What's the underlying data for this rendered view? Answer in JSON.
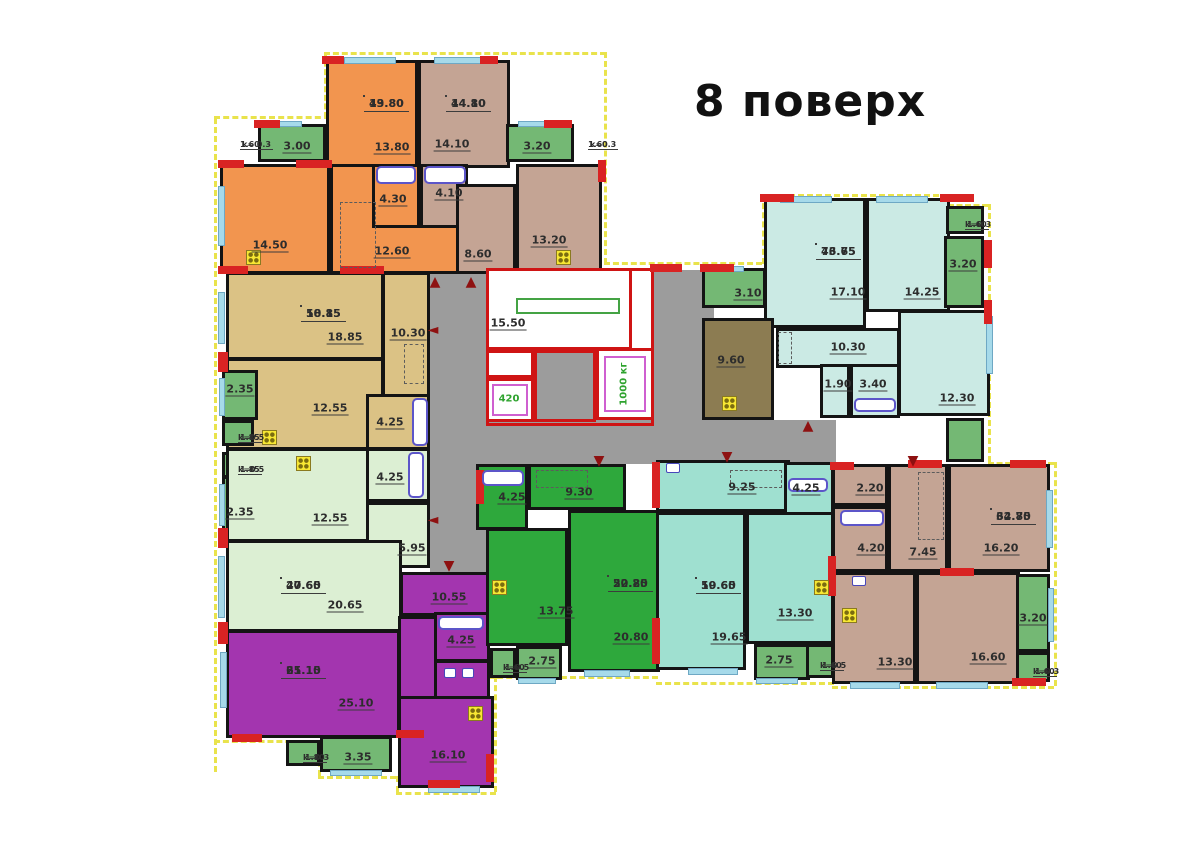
{
  "title": "8 поверх",
  "palette": {
    "orange": "#f2954f",
    "tan": "#c4a494",
    "khaki": "#dbc285",
    "lightgreen": "#dcefd3",
    "balc": "#74b874",
    "darkgreen": "#2ea83c",
    "teal": "#9fe0d0",
    "lightteal": "#cbeae4",
    "purple": "#a335af",
    "olive": "#8c7c52",
    "grey": "#9c9c9c",
    "white": "#ffffff",
    "red_wall": "#cf1414",
    "window": "#a6daea",
    "outline_yellow": "#e9e34c"
  },
  "corridors": [
    [
      "corridor-left",
      "grey",
      430,
      270,
      58,
      304
    ],
    [
      "corridor-bottom",
      "grey",
      430,
      420,
      406,
      44
    ],
    [
      "corridor-right",
      "grey",
      654,
      270,
      60,
      154
    ]
  ],
  "rooms": [
    [
      "room-13-80",
      "orange",
      326,
      60,
      92,
      108,
      ""
    ],
    [
      "room-14-50",
      "orange",
      220,
      164,
      110,
      110,
      ""
    ],
    [
      "room-12-60",
      "orange",
      330,
      164,
      130,
      110,
      ""
    ],
    [
      "bath-4-30",
      "orange",
      372,
      164,
      48,
      64,
      ""
    ],
    [
      "room-14-10",
      "tan",
      418,
      60,
      92,
      108,
      ""
    ],
    [
      "bath-4-10",
      "tan",
      420,
      164,
      48,
      64,
      ""
    ],
    [
      "hall-8-60",
      "tan",
      456,
      184,
      60,
      90,
      ""
    ],
    [
      "kitchen-13-20",
      "tan",
      516,
      164,
      86,
      110,
      ""
    ],
    [
      "balcony-3-00",
      "balc",
      258,
      124,
      68,
      38,
      ""
    ],
    [
      "balcony-3-20-top",
      "balc",
      506,
      124,
      68,
      38,
      ""
    ],
    [
      "room-18-85",
      "khaki",
      226,
      272,
      158,
      88,
      ""
    ],
    [
      "hall-10-30-left",
      "khaki",
      382,
      272,
      48,
      130,
      ""
    ],
    [
      "room-12-55-khaki",
      "khaki",
      226,
      358,
      158,
      92,
      ""
    ],
    [
      "bath-4-25-khaki",
      "khaki",
      366,
      394,
      64,
      56,
      ""
    ],
    [
      "balcony-2-35-a",
      "balc",
      222,
      370,
      36,
      50,
      ""
    ],
    [
      "coefbox-1-85-a",
      "balc",
      222,
      420,
      32,
      26,
      ""
    ],
    [
      "coefbox-1-85-b",
      "balc",
      222,
      452,
      32,
      26,
      ""
    ],
    [
      "balcony-2-35-b",
      "balc",
      222,
      476,
      36,
      56,
      ""
    ],
    [
      "room-12-55-green",
      "lightgreen",
      226,
      448,
      158,
      94,
      ""
    ],
    [
      "bath-4-25-green",
      "lightgreen",
      366,
      448,
      64,
      54,
      ""
    ],
    [
      "hall-5-95",
      "lightgreen",
      366,
      502,
      64,
      66,
      ""
    ],
    [
      "room-20-65",
      "lightgreen",
      226,
      540,
      176,
      92,
      ""
    ],
    [
      "hall-10-55",
      "purple",
      400,
      572,
      90,
      44,
      ""
    ],
    [
      "hall-purple",
      "purple",
      398,
      616,
      42,
      118,
      ""
    ],
    [
      "bath-4-25-purple",
      "purple",
      434,
      612,
      56,
      50,
      ""
    ],
    [
      "wc-purple",
      "purple",
      434,
      660,
      56,
      40,
      ""
    ],
    [
      "room-25-10",
      "purple",
      226,
      630,
      174,
      108,
      ""
    ],
    [
      "room-16-10",
      "purple",
      398,
      696,
      96,
      92,
      ""
    ],
    [
      "balcony-3-35",
      "balc",
      320,
      736,
      72,
      36,
      ""
    ],
    [
      "coefbox-1-80",
      "balc",
      286,
      740,
      34,
      26,
      ""
    ],
    [
      "coefbox-1-60-mid",
      "balc",
      490,
      648,
      26,
      30,
      ""
    ],
    [
      "bath-4-25-dgreen",
      "darkgreen",
      476,
      464,
      52,
      66,
      ""
    ],
    [
      "hall-9-30",
      "darkgreen",
      528,
      464,
      98,
      46,
      ""
    ],
    [
      "kitchen-13-75",
      "darkgreen",
      486,
      528,
      82,
      118,
      ""
    ],
    [
      "room-20-80",
      "darkgreen",
      568,
      510,
      92,
      162,
      ""
    ],
    [
      "balcony-2-75-a",
      "balc",
      516,
      646,
      46,
      34,
      ""
    ],
    [
      "hall-9-25",
      "teal",
      656,
      460,
      134,
      52,
      ""
    ],
    [
      "bath-4-25-teal",
      "teal",
      784,
      462,
      50,
      64,
      ""
    ],
    [
      "room-19-65",
      "teal",
      656,
      512,
      90,
      158,
      ""
    ],
    [
      "kitchen-13-30-teal",
      "teal",
      746,
      512,
      88,
      132,
      ""
    ],
    [
      "balcony-2-75-b",
      "balc",
      754,
      644,
      56,
      36,
      ""
    ],
    [
      "coefbox-1-60-teal",
      "balc",
      806,
      644,
      28,
      34,
      ""
    ],
    [
      "wc-2-20",
      "tan",
      832,
      464,
      56,
      42,
      ""
    ],
    [
      "bath-4-20",
      "tan",
      832,
      506,
      56,
      66,
      ""
    ],
    [
      "hall-7-45",
      "tan",
      888,
      464,
      60,
      108,
      ""
    ],
    [
      "room-16-20",
      "tan",
      948,
      464,
      102,
      108,
      ""
    ],
    [
      "kitchen-13-30-tan",
      "tan",
      832,
      572,
      84,
      112,
      ""
    ],
    [
      "room-16-60",
      "tan",
      916,
      572,
      104,
      112,
      ""
    ],
    [
      "balcony-3-20-right",
      "balc",
      1016,
      574,
      34,
      78,
      "hatch"
    ],
    [
      "coefbox-1-60-br",
      "balc",
      1016,
      652,
      34,
      30,
      ""
    ],
    [
      "room-17-10",
      "lightteal",
      764,
      198,
      102,
      130,
      ""
    ],
    [
      "room-14-25",
      "lightteal",
      866,
      198,
      84,
      114,
      ""
    ],
    [
      "hall-10-30-right",
      "lightteal",
      776,
      328,
      124,
      40,
      ""
    ],
    [
      "wc-1-90",
      "lightteal",
      820,
      364,
      30,
      54,
      ""
    ],
    [
      "bath-3-40",
      "lightteal",
      850,
      364,
      50,
      54,
      ""
    ],
    [
      "room-12-30",
      "lightteal",
      898,
      310,
      92,
      106,
      ""
    ],
    [
      "kitchen-9-60",
      "olive",
      702,
      318,
      72,
      102,
      ""
    ],
    [
      "balcony-3-10",
      "balc",
      702,
      268,
      64,
      40,
      ""
    ],
    [
      "balcony-3-20-topright",
      "balc",
      944,
      236,
      40,
      72,
      "hatch"
    ],
    [
      "coefbox-1-60-tr",
      "balc",
      946,
      206,
      38,
      28,
      ""
    ],
    [
      "balcony-small-right",
      "balc",
      946,
      418,
      38,
      44,
      ""
    ]
  ],
  "core": {
    "frame": [
      486,
      268,
      168,
      158
    ],
    "stair_room": [
      486,
      268,
      146,
      82
    ],
    "stair_label": {
      "t": "15.50",
      "x": 508,
      "y": 324
    },
    "rail": [
      516,
      298,
      104,
      16
    ],
    "cells": [
      [
        "core-cell",
        "white",
        486,
        350,
        48,
        28
      ],
      [
        "lift-420-shaft",
        "white",
        486,
        378,
        48,
        44
      ],
      [
        "lift-1000-shaft",
        "white",
        596,
        348,
        58,
        72
      ],
      [
        "core-vestibule",
        "grey",
        534,
        350,
        62,
        72
      ]
    ],
    "lift_boxes": [
      [
        492,
        384,
        36,
        32
      ],
      [
        604,
        356,
        42,
        56
      ]
    ],
    "lift_labels": [
      {
        "t": "420",
        "x": 509,
        "y": 399,
        "rot": false
      },
      {
        "t": "1000 кг",
        "x": 624,
        "y": 384,
        "rot": true
      }
    ]
  },
  "labels": [
    {
      "t": "3.00",
      "x": 297,
      "y": 147
    },
    {
      "t": "13.80",
      "x": 392,
      "y": 148
    },
    {
      "t": "14.10",
      "x": 452,
      "y": 145
    },
    {
      "t": "3.20",
      "x": 537,
      "y": 147
    },
    {
      "t": "14.50",
      "x": 270,
      "y": 246
    },
    {
      "t": "4.30",
      "x": 393,
      "y": 200
    },
    {
      "t": "4.10",
      "x": 449,
      "y": 194
    },
    {
      "t": "12.60",
      "x": 392,
      "y": 252
    },
    {
      "t": "8.60",
      "x": 478,
      "y": 255
    },
    {
      "t": "13.20",
      "x": 549,
      "y": 241
    },
    {
      "t": "18.85",
      "x": 345,
      "y": 338
    },
    {
      "t": "10.30",
      "x": 408,
      "y": 334
    },
    {
      "t": "12.55",
      "x": 330,
      "y": 409
    },
    {
      "t": "4.25",
      "x": 390,
      "y": 423
    },
    {
      "t": "2.35",
      "x": 240,
      "y": 390
    },
    {
      "t": "2.35",
      "x": 240,
      "y": 513
    },
    {
      "t": "12.55",
      "x": 330,
      "y": 519
    },
    {
      "t": "4.25",
      "x": 390,
      "y": 478
    },
    {
      "t": "5.95",
      "x": 412,
      "y": 549
    },
    {
      "t": "20.65",
      "x": 345,
      "y": 606
    },
    {
      "t": "10.55",
      "x": 449,
      "y": 598
    },
    {
      "t": "25.10",
      "x": 356,
      "y": 704
    },
    {
      "t": "4.25",
      "x": 461,
      "y": 641
    },
    {
      "t": "16.10",
      "x": 448,
      "y": 756
    },
    {
      "t": "3.35",
      "x": 358,
      "y": 758
    },
    {
      "t": "4.25",
      "x": 512,
      "y": 498
    },
    {
      "t": "9.30",
      "x": 579,
      "y": 493
    },
    {
      "t": "13.75",
      "x": 556,
      "y": 612
    },
    {
      "t": "20.80",
      "x": 631,
      "y": 638
    },
    {
      "t": "2.75",
      "x": 542,
      "y": 662
    },
    {
      "t": "9.25",
      "x": 742,
      "y": 488
    },
    {
      "t": "4.25",
      "x": 806,
      "y": 489
    },
    {
      "t": "19.65",
      "x": 729,
      "y": 638
    },
    {
      "t": "13.30",
      "x": 795,
      "y": 614
    },
    {
      "t": "2.75",
      "x": 779,
      "y": 661
    },
    {
      "t": "2.20",
      "x": 870,
      "y": 489
    },
    {
      "t": "4.20",
      "x": 871,
      "y": 549
    },
    {
      "t": "7.45",
      "x": 923,
      "y": 553
    },
    {
      "t": "16.20",
      "x": 1001,
      "y": 549
    },
    {
      "t": "13.30",
      "x": 895,
      "y": 663
    },
    {
      "t": "16.60",
      "x": 988,
      "y": 658
    },
    {
      "t": "3.20",
      "x": 1033,
      "y": 619
    },
    {
      "t": "3.10",
      "x": 748,
      "y": 294
    },
    {
      "t": "9.60",
      "x": 731,
      "y": 361
    },
    {
      "t": "17.10",
      "x": 848,
      "y": 293
    },
    {
      "t": "14.25",
      "x": 922,
      "y": 293
    },
    {
      "t": "10.30",
      "x": 848,
      "y": 348
    },
    {
      "t": "1.90",
      "x": 838,
      "y": 385
    },
    {
      "t": "3.40",
      "x": 873,
      "y": 385
    },
    {
      "t": "12.30",
      "x": 957,
      "y": 399
    },
    {
      "t": "3.20",
      "x": 963,
      "y": 265
    }
  ],
  "area_boxes": [
    {
      "top": "13.80",
      "bottom": "49.80",
      "x": 364,
      "y": 96
    },
    {
      "top": "14.10",
      "bottom": "44.80",
      "x": 446,
      "y": 96
    },
    {
      "top": "18.85",
      "bottom": "50.15",
      "x": 301,
      "y": 306
    },
    {
      "top": "20.65",
      "bottom": "47.60",
      "x": 281,
      "y": 578
    },
    {
      "top": "25.10",
      "bottom": "61.15",
      "x": 281,
      "y": 663
    },
    {
      "top": "20.80",
      "bottom": "52.25",
      "x": 608,
      "y": 576
    },
    {
      "top": "19.65",
      "bottom": "50.60",
      "x": 696,
      "y": 578
    },
    {
      "top": "32.80",
      "bottom": "64.75",
      "x": 991,
      "y": 509
    },
    {
      "top": "43.65",
      "bottom": "76.75",
      "x": 816,
      "y": 244
    }
  ],
  "coef_labels": [
    {
      "top": "k= 0.3",
      "bottom": "1.60",
      "x": 240,
      "y": 140
    },
    {
      "top": "k=0.3",
      "bottom": "1.60",
      "x": 588,
      "y": 140
    },
    {
      "top": "1.85",
      "bottom": "k=0.5",
      "x": 238,
      "y": 433
    },
    {
      "top": "1.85",
      "bottom": "k=0.5",
      "x": 238,
      "y": 465
    },
    {
      "top": "1.80",
      "bottom": "k=0.3",
      "x": 303,
      "y": 753
    },
    {
      "top": "1.60",
      "bottom": "k=0.5",
      "x": 503,
      "y": 663
    },
    {
      "top": "1.60",
      "bottom": "k=0.5",
      "x": 820,
      "y": 661
    },
    {
      "top": "1.60",
      "bottom": "k=0.3",
      "x": 1033,
      "y": 667
    },
    {
      "top": "1.60",
      "bottom": "k=0.3",
      "x": 965,
      "y": 220
    }
  ],
  "arrows": [
    {
      "d": "up",
      "x": 435,
      "y": 282
    },
    {
      "d": "up",
      "x": 471,
      "y": 282
    },
    {
      "d": "left",
      "x": 433,
      "y": 330
    },
    {
      "d": "left",
      "x": 433,
      "y": 520
    },
    {
      "d": "down",
      "x": 449,
      "y": 566
    },
    {
      "d": "down",
      "x": 599,
      "y": 461
    },
    {
      "d": "down",
      "x": 727,
      "y": 457
    },
    {
      "d": "up",
      "x": 808,
      "y": 426
    },
    {
      "d": "down",
      "x": 913,
      "y": 461
    }
  ],
  "windows": [
    [
      344,
      57,
      52,
      7
    ],
    [
      434,
      57,
      56,
      7
    ],
    [
      266,
      121,
      36,
      6
    ],
    [
      518,
      121,
      36,
      6
    ],
    [
      218,
      186,
      7,
      60
    ],
    [
      218,
      292,
      7,
      52
    ],
    [
      219,
      378,
      6,
      38
    ],
    [
      219,
      484,
      6,
      42
    ],
    [
      218,
      556,
      7,
      62
    ],
    [
      220,
      652,
      7,
      56
    ],
    [
      330,
      770,
      52,
      6
    ],
    [
      428,
      786,
      52,
      7
    ],
    [
      518,
      678,
      38,
      6
    ],
    [
      756,
      678,
      42,
      6
    ],
    [
      584,
      670,
      46,
      7
    ],
    [
      688,
      668,
      50,
      7
    ],
    [
      850,
      682,
      50,
      7
    ],
    [
      936,
      682,
      52,
      7
    ],
    [
      780,
      196,
      52,
      7
    ],
    [
      876,
      196,
      52,
      7
    ],
    [
      706,
      266,
      38,
      6
    ],
    [
      986,
      316,
      7,
      58
    ],
    [
      1046,
      490,
      7,
      58
    ],
    [
      1048,
      588,
      6,
      54
    ]
  ],
  "accents": [
    [
      322,
      56,
      22,
      8
    ],
    [
      480,
      56,
      18,
      8
    ],
    [
      254,
      120,
      26,
      8
    ],
    [
      544,
      120,
      28,
      8
    ],
    [
      218,
      160,
      26,
      8
    ],
    [
      296,
      160,
      36,
      8
    ],
    [
      218,
      266,
      30,
      8
    ],
    [
      340,
      266,
      44,
      8
    ],
    [
      598,
      160,
      8,
      22
    ],
    [
      218,
      352,
      10,
      20
    ],
    [
      218,
      528,
      10,
      20
    ],
    [
      218,
      622,
      10,
      22
    ],
    [
      232,
      734,
      30,
      8
    ],
    [
      396,
      730,
      28,
      8
    ],
    [
      428,
      780,
      32,
      8
    ],
    [
      486,
      754,
      8,
      28
    ],
    [
      476,
      470,
      8,
      34
    ],
    [
      652,
      462,
      8,
      46
    ],
    [
      652,
      618,
      8,
      46
    ],
    [
      830,
      462,
      24,
      8
    ],
    [
      828,
      556,
      8,
      40
    ],
    [
      908,
      460,
      34,
      8
    ],
    [
      1010,
      460,
      36,
      8
    ],
    [
      940,
      568,
      34,
      8
    ],
    [
      1012,
      678,
      34,
      8
    ],
    [
      650,
      264,
      32,
      8
    ],
    [
      700,
      264,
      34,
      8
    ],
    [
      760,
      194,
      34,
      8
    ],
    [
      940,
      194,
      34,
      8
    ],
    [
      984,
      240,
      8,
      28
    ],
    [
      984,
      300,
      8,
      24
    ]
  ],
  "wardrobes": [
    [
      340,
      202,
      36,
      66
    ],
    [
      404,
      344,
      20,
      40
    ],
    [
      918,
      472,
      26,
      68
    ],
    [
      536,
      470,
      52,
      18
    ],
    [
      730,
      470,
      52,
      18
    ],
    [
      778,
      332,
      14,
      32
    ]
  ],
  "tubs": [
    [
      376,
      166,
      40,
      18
    ],
    [
      424,
      166,
      42,
      18
    ],
    [
      412,
      398,
      16,
      48
    ],
    [
      408,
      452,
      16,
      46
    ],
    [
      438,
      616,
      46,
      14
    ],
    [
      482,
      470,
      42,
      16
    ],
    [
      854,
      398,
      42,
      14
    ],
    [
      840,
      510,
      44,
      16
    ],
    [
      788,
      478,
      40,
      14
    ]
  ],
  "stoves": [
    [
      246,
      250,
      15,
      15
    ],
    [
      556,
      250,
      15,
      15
    ],
    [
      262,
      430,
      15,
      15
    ],
    [
      296,
      456,
      15,
      15
    ],
    [
      468,
      706,
      15,
      15
    ],
    [
      492,
      580,
      15,
      15
    ],
    [
      814,
      580,
      15,
      15
    ],
    [
      842,
      608,
      15,
      15
    ],
    [
      722,
      396,
      15,
      15
    ]
  ],
  "sinks": [
    [
      444,
      668,
      12,
      10
    ],
    [
      462,
      668,
      12,
      10
    ],
    [
      852,
      576,
      14,
      10
    ],
    [
      666,
      463,
      14,
      10
    ]
  ],
  "outline": [
    {
      "dir": "v",
      "x": 214,
      "y": 118,
      "len": 654
    },
    {
      "dir": "h",
      "x": 214,
      "y": 116,
      "len": 116
    },
    {
      "dir": "v",
      "x": 324,
      "y": 52,
      "len": 66
    },
    {
      "dir": "h",
      "x": 324,
      "y": 52,
      "len": 282
    },
    {
      "dir": "v",
      "x": 604,
      "y": 52,
      "len": 212
    },
    {
      "dir": "h",
      "x": 604,
      "y": 262,
      "len": 158
    },
    {
      "dir": "v",
      "x": 762,
      "y": 194,
      "len": 70
    },
    {
      "dir": "h",
      "x": 762,
      "y": 194,
      "len": 186
    },
    {
      "dir": "h",
      "x": 948,
      "y": 204,
      "len": 40
    },
    {
      "dir": "v",
      "x": 988,
      "y": 204,
      "len": 258
    },
    {
      "dir": "h",
      "x": 988,
      "y": 462,
      "len": 66
    },
    {
      "dir": "v",
      "x": 1054,
      "y": 462,
      "len": 224
    },
    {
      "dir": "h",
      "x": 832,
      "y": 686,
      "len": 222
    },
    {
      "dir": "h",
      "x": 656,
      "y": 682,
      "len": 178
    },
    {
      "dir": "h",
      "x": 488,
      "y": 676,
      "len": 170
    },
    {
      "dir": "v",
      "x": 494,
      "y": 676,
      "len": 116
    },
    {
      "dir": "h",
      "x": 396,
      "y": 792,
      "len": 100
    },
    {
      "dir": "v",
      "x": 396,
      "y": 776,
      "len": 16
    },
    {
      "dir": "h",
      "x": 318,
      "y": 776,
      "len": 78
    },
    {
      "dir": "v",
      "x": 318,
      "y": 742,
      "len": 34
    },
    {
      "dir": "h",
      "x": 214,
      "y": 740,
      "len": 104
    }
  ]
}
